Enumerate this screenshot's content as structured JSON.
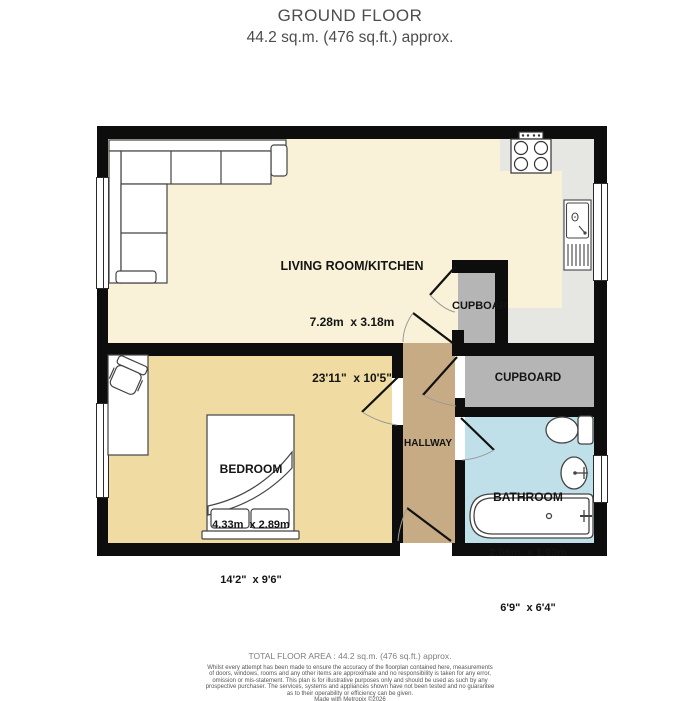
{
  "title": {
    "line1": "GROUND FLOOR",
    "line2": "44.2 sq.m. (476 sq.ft.) approx."
  },
  "rooms": {
    "living": {
      "name": "LIVING ROOM/KITCHEN",
      "metric": "7.28m  x 3.18m",
      "imperial": "23'11\"  x 10'5\""
    },
    "bedroom": {
      "name": "BEDROOM",
      "metric": "4.33m  x 2.89m",
      "imperial": "14'2\"  x 9'6\""
    },
    "bathroom": {
      "name": "BATHROOM",
      "metric": "2.06m  x 1.93m",
      "imperial": "6'9\"  x 6'4\""
    },
    "hallway": {
      "name": "HALLWAY"
    },
    "cupboard_upper": {
      "name": "CUPBOAR"
    },
    "cupboard_lower": {
      "name": "CUPBOARD"
    }
  },
  "footer": {
    "total": "TOTAL FLOOR AREA : 44.2 sq.m. (476 sq.ft.) approx.",
    "disclaimer_lines": [
      "Whilst every attempt has been made to ensure the accuracy of the floorplan contained here, measurements",
      "of doors, windows, rooms and any other items are approximate and no responsibility is taken for any error,",
      "omission or mis-statement. This plan is for illustrative purposes only and should be used as such by any",
      "prospective purchaser. The services, systems and appliances shown have not been tested and no guarantee",
      "as to their operability or efficiency can be given.",
      "Made with Metropix ©2026"
    ]
  },
  "colors": {
    "wall": "#0d0d0d",
    "living_floor": "#f9f2d9",
    "bedroom_floor": "#f0dca3",
    "hallway_floor": "#c6ab84",
    "bathroom_floor": "#bfe0e8",
    "cupboard_floor": "#b5b5b5",
    "counter": "#e6e6e3"
  }
}
